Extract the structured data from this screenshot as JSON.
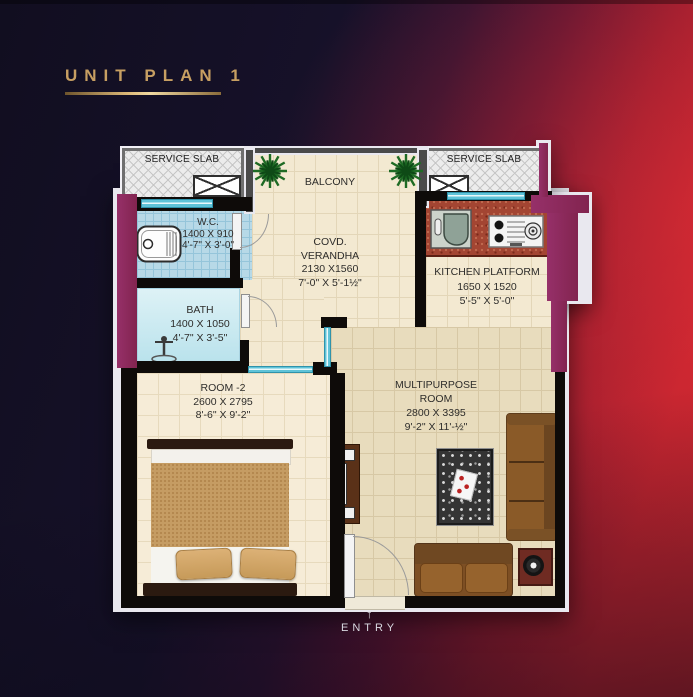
{
  "title": {
    "text": "UNIT PLAN 1"
  },
  "plan": {
    "service_slab_left": {
      "label": "SERVICE SLAB"
    },
    "service_slab_right": {
      "label": "SERVICE SLAB"
    },
    "balcony": {
      "label": "BALCONY"
    },
    "wc": {
      "lines": [
        "W.C.",
        "1400 X 910",
        "4'-7\" X 3'-0\""
      ]
    },
    "bath": {
      "lines": [
        "BATH",
        "1400 X 1050",
        "4'-7\" X 3'-5\""
      ]
    },
    "verandha": {
      "lines": [
        "COVD.",
        "VERANDHA",
        "2130 X1560",
        "7'-0\" X 5'-1½\""
      ]
    },
    "kitchen": {
      "lines": [
        "KITCHEN PLATFORM",
        "1650 X 1520",
        "5'-5\" X 5'-0\""
      ]
    },
    "room2": {
      "lines": [
        "ROOM -2",
        "2600 X 2795",
        "8'-6\" X 9'-2\""
      ]
    },
    "multipurpose": {
      "lines": [
        "MULTIPURPOSE",
        "ROOM",
        "2800 X 3395",
        "9'-2\" X 11'-½\""
      ]
    },
    "entry": {
      "label": "ENTRY",
      "arrow": "↑"
    }
  },
  "colors": {
    "background_dark": "#14102a",
    "background_red": "#c5242f",
    "title_gold": "#c79f62",
    "wall_magenta": "#8c2a61",
    "wall_black": "#0e0b09",
    "floor_cream": "#f3e9d1",
    "floor_multipurpose": "#e8dcbd",
    "floor_room2": "#f6ecd7",
    "tile_wc_blue": "#b7d9e7",
    "tile_bath_blue": "#cdeaf2",
    "window_cyan": "#5fc3d8",
    "kitchen_brick": "#a34532",
    "sofa_brown": "#8f5d2a",
    "bed_tan": "#c59c63",
    "wood_dark": "#2b1a10"
  }
}
